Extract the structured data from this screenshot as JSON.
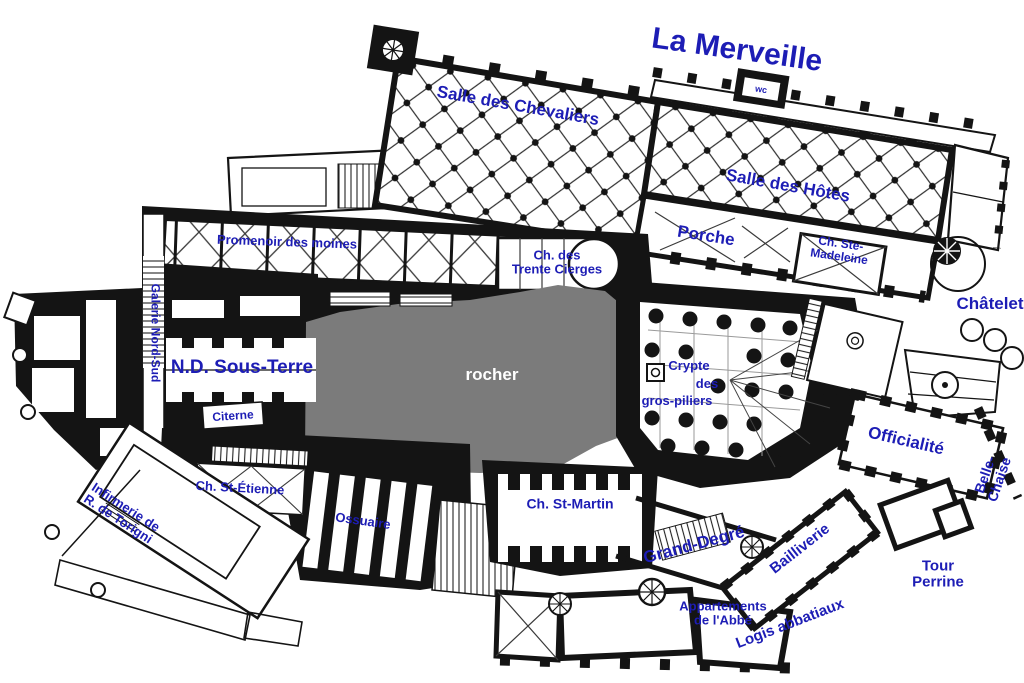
{
  "colors": {
    "label_blue": "#1d1db5",
    "rock_gray": "#7b7b7b",
    "ink_black": "#141414",
    "paper_white": "#ffffff"
  },
  "labels": [
    {
      "id": "la-merveille",
      "text": "La Merveille",
      "x": 737,
      "y": 50,
      "rot": 8,
      "size": 30
    },
    {
      "id": "salle-des-chevaliers",
      "text": "Salle des Chevaliers",
      "x": 518,
      "y": 106,
      "rot": 10,
      "size": 17
    },
    {
      "id": "wc",
      "text": "wc",
      "x": 761,
      "y": 90,
      "rot": 9,
      "size": 9,
      "bg": true
    },
    {
      "id": "salle-des-hotes",
      "text": "Salle des Hôtes",
      "x": 788,
      "y": 186,
      "rot": 10,
      "size": 17
    },
    {
      "id": "porche",
      "text": "Porche",
      "x": 706,
      "y": 236,
      "rot": 9,
      "size": 17
    },
    {
      "id": "ch-ste-madeleine",
      "text": "Ch. Ste-\nMadeleine",
      "x": 840,
      "y": 250,
      "rot": 8,
      "size": 12
    },
    {
      "id": "chatelet",
      "text": "Châtelet",
      "x": 990,
      "y": 304,
      "rot": 0,
      "size": 17
    },
    {
      "id": "promenoir-des-moines",
      "text": "Promenoir des moines",
      "x": 287,
      "y": 242,
      "rot": 2,
      "size": 13
    },
    {
      "id": "galerie-nord-sud",
      "text": "Galerie Nord-Sud",
      "x": 155,
      "y": 333,
      "rot": 90,
      "size": 12
    },
    {
      "id": "nd-sous-terre",
      "text": "N.D. Sous-Terre",
      "x": 242,
      "y": 368,
      "rot": 0,
      "size": 19
    },
    {
      "id": "citerne",
      "text": "Citerne",
      "x": 233,
      "y": 416,
      "rot": -4,
      "size": 12
    },
    {
      "id": "ch-des-trente-cierges",
      "text": "Ch. des\nTrente Cierges",
      "x": 557,
      "y": 262,
      "rot": 0,
      "size": 13
    },
    {
      "id": "rocher",
      "text": "rocher",
      "x": 492,
      "y": 375,
      "rot": 0,
      "size": 17,
      "color": "#ffffff"
    },
    {
      "id": "crypte-line1",
      "text": "Crypte",
      "x": 689,
      "y": 366,
      "rot": 0,
      "size": 13
    },
    {
      "id": "crypte-line2",
      "text": "des",
      "x": 707,
      "y": 384,
      "rot": 0,
      "size": 13
    },
    {
      "id": "crypte-line3",
      "text": "gros-piliers",
      "x": 677,
      "y": 401,
      "rot": 0,
      "size": 13
    },
    {
      "id": "officialite",
      "text": "Officialité",
      "x": 906,
      "y": 441,
      "rot": 13,
      "size": 17
    },
    {
      "id": "belle-chaise",
      "text": "Belle-Chaise",
      "x": 992,
      "y": 477,
      "rot": -71,
      "size": 14
    },
    {
      "id": "infirmerie",
      "text": "Infirmerie de\nR. de Torigni",
      "x": 122,
      "y": 513,
      "rot": 33,
      "size": 13
    },
    {
      "id": "ch-st-etienne",
      "text": "Ch. St-Étienne",
      "x": 240,
      "y": 488,
      "rot": 3,
      "size": 13
    },
    {
      "id": "ossuaire",
      "text": "Ossuaire",
      "x": 363,
      "y": 521,
      "rot": 8,
      "size": 13
    },
    {
      "id": "ch-st-martin",
      "text": "Ch. St-Martin",
      "x": 570,
      "y": 504,
      "rot": 0,
      "size": 14
    },
    {
      "id": "grand-degre",
      "text": "Grand-Degré",
      "x": 694,
      "y": 545,
      "rot": -15,
      "size": 17
    },
    {
      "id": "appartements-de-l-abbe",
      "text": "Appartements\nde l'Abbé",
      "x": 723,
      "y": 613,
      "rot": 0,
      "size": 13
    },
    {
      "id": "bailliverie",
      "text": "Bailliverie",
      "x": 800,
      "y": 549,
      "rot": -38,
      "size": 15
    },
    {
      "id": "tour-perrine",
      "text": "Tour\nPerrine",
      "x": 938,
      "y": 574,
      "rot": 0,
      "size": 15
    },
    {
      "id": "logis-abbatiaux",
      "text": "Logis abbatiaux",
      "x": 790,
      "y": 624,
      "rot": -21,
      "size": 15
    }
  ]
}
